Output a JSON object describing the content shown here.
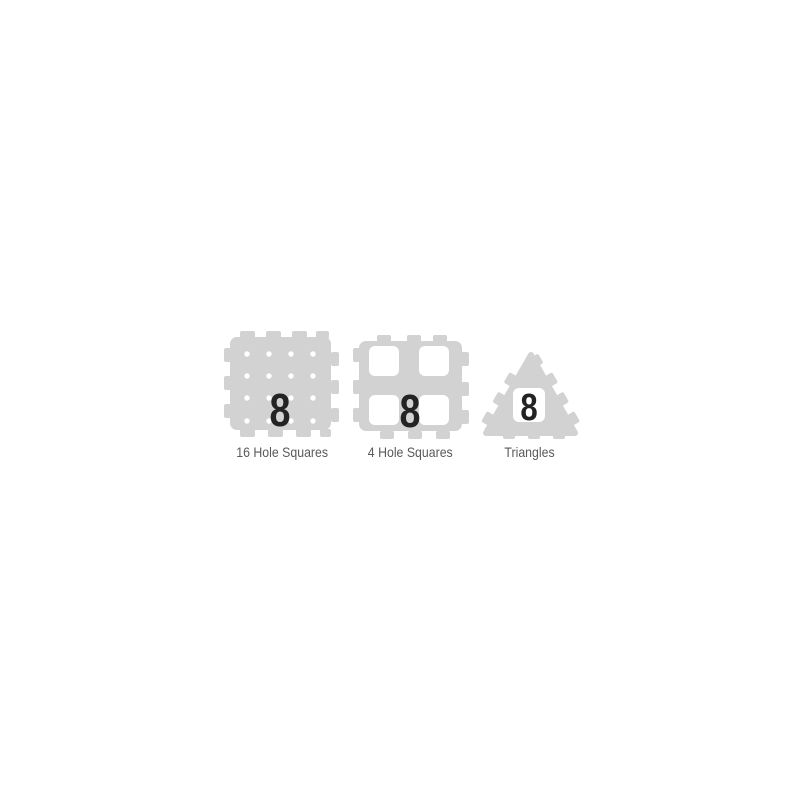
{
  "colors": {
    "background": "#ffffff",
    "tile": "#d2d2d2",
    "hole": "#ffffff",
    "number": "#232323",
    "label": "#58595b"
  },
  "items": [
    {
      "name": "16-hole-squares",
      "label": "16 Hole Squares",
      "count": "8"
    },
    {
      "name": "4-hole-squares",
      "label": "4 Hole Squares",
      "count": "8"
    },
    {
      "name": "triangles",
      "label": "Triangles",
      "count": "8"
    }
  ]
}
